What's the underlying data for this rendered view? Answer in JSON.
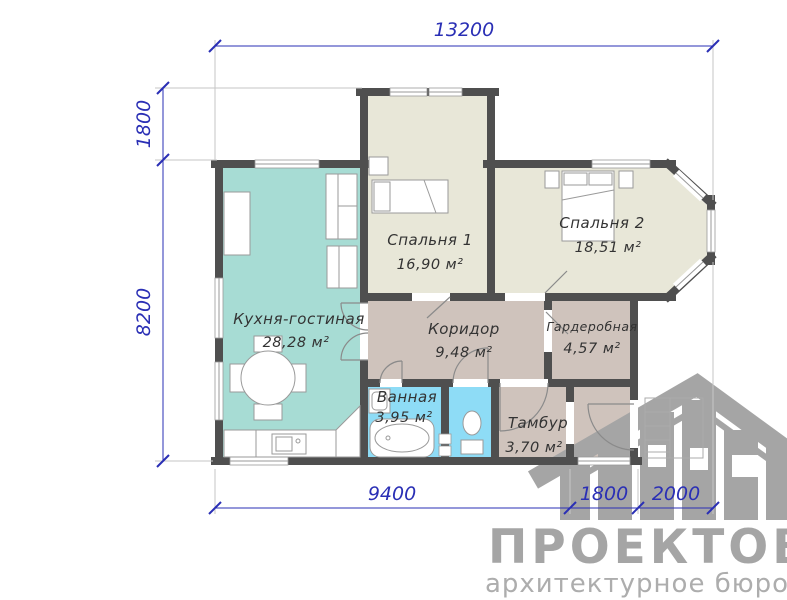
{
  "dimensions": {
    "top_width": "13200",
    "left_upper": "1800",
    "left_height": "8200",
    "bottom_main": "9400",
    "bottom_tambur": "1800",
    "bottom_porch": "2000"
  },
  "rooms": [
    {
      "name": "Кухня-гостиная",
      "area": "28,28 м²",
      "color": "#a7dcd4"
    },
    {
      "name": "Спальня 1",
      "area": "16,90 м²",
      "color": "#e8e7d8"
    },
    {
      "name": "Спальня 2",
      "area": "18,51 м²",
      "color": "#e8e7d8"
    },
    {
      "name": "Коридор",
      "area": "9,48 м²",
      "color": "#cfc3bc"
    },
    {
      "name": "Гардеробная",
      "area": "4,57 м²",
      "color": "#cfc3bc"
    },
    {
      "name": "Ванная",
      "area": "3,95 м²",
      "color": "#8edcf6"
    },
    {
      "name": "Тамбур",
      "area": "3,70 м²",
      "color": "#cfc3bc"
    }
  ],
  "watermark": {
    "brand_name": "ПРОЕКТОВ",
    "tagline": "архитектурное бюро"
  },
  "colors": {
    "wall": "#4f4f4f",
    "dimension": "#2a2fb5",
    "watermark": "#a5a5a5",
    "watermark_light": "#adadad"
  }
}
